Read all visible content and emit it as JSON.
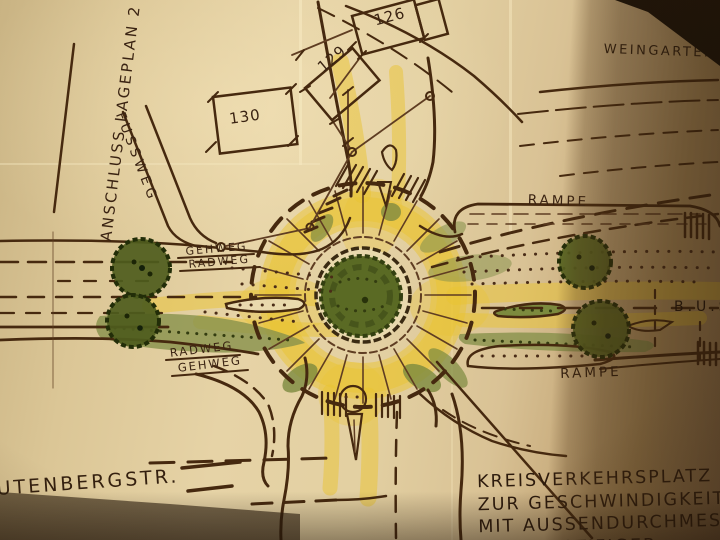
{
  "plan": {
    "corner_note": "ANSCHLUSS LAGEPLAN 2",
    "streets": {
      "top_right": "WEINGARTENST",
      "bottom_left": "UTENBERGSTR."
    },
    "path_labels": {
      "fussweg": "FUSSWEG",
      "gehweg_upper": "GEHWEG",
      "radweg_upper": "RADWEG",
      "radweg_lower": "RADWEG",
      "gehweg_lower": "GEHWEG"
    },
    "ramp_labels": {
      "upper": "RAMPE",
      "lower": "RAMPE"
    },
    "bus_label": "B.U.S",
    "plot_numbers": [
      "130",
      "129",
      "126"
    ],
    "title_block": {
      "line1": "KREISVERKEHRSPLATZ",
      "line2": "ZUR GESCHWINDIGKEIT",
      "line3": "MIT AUSSENDURCHMES",
      "line4": "AUSSTOSTIFIGER"
    }
  },
  "colors": {
    "paper": "#e3d0a2",
    "paper_fold_shadow": "#8a6b44",
    "ink_sepia": "#46290f",
    "highlighter_yellow": "#eac431",
    "marker_green": "#87914b",
    "tree_green": "#4e5c1d"
  }
}
